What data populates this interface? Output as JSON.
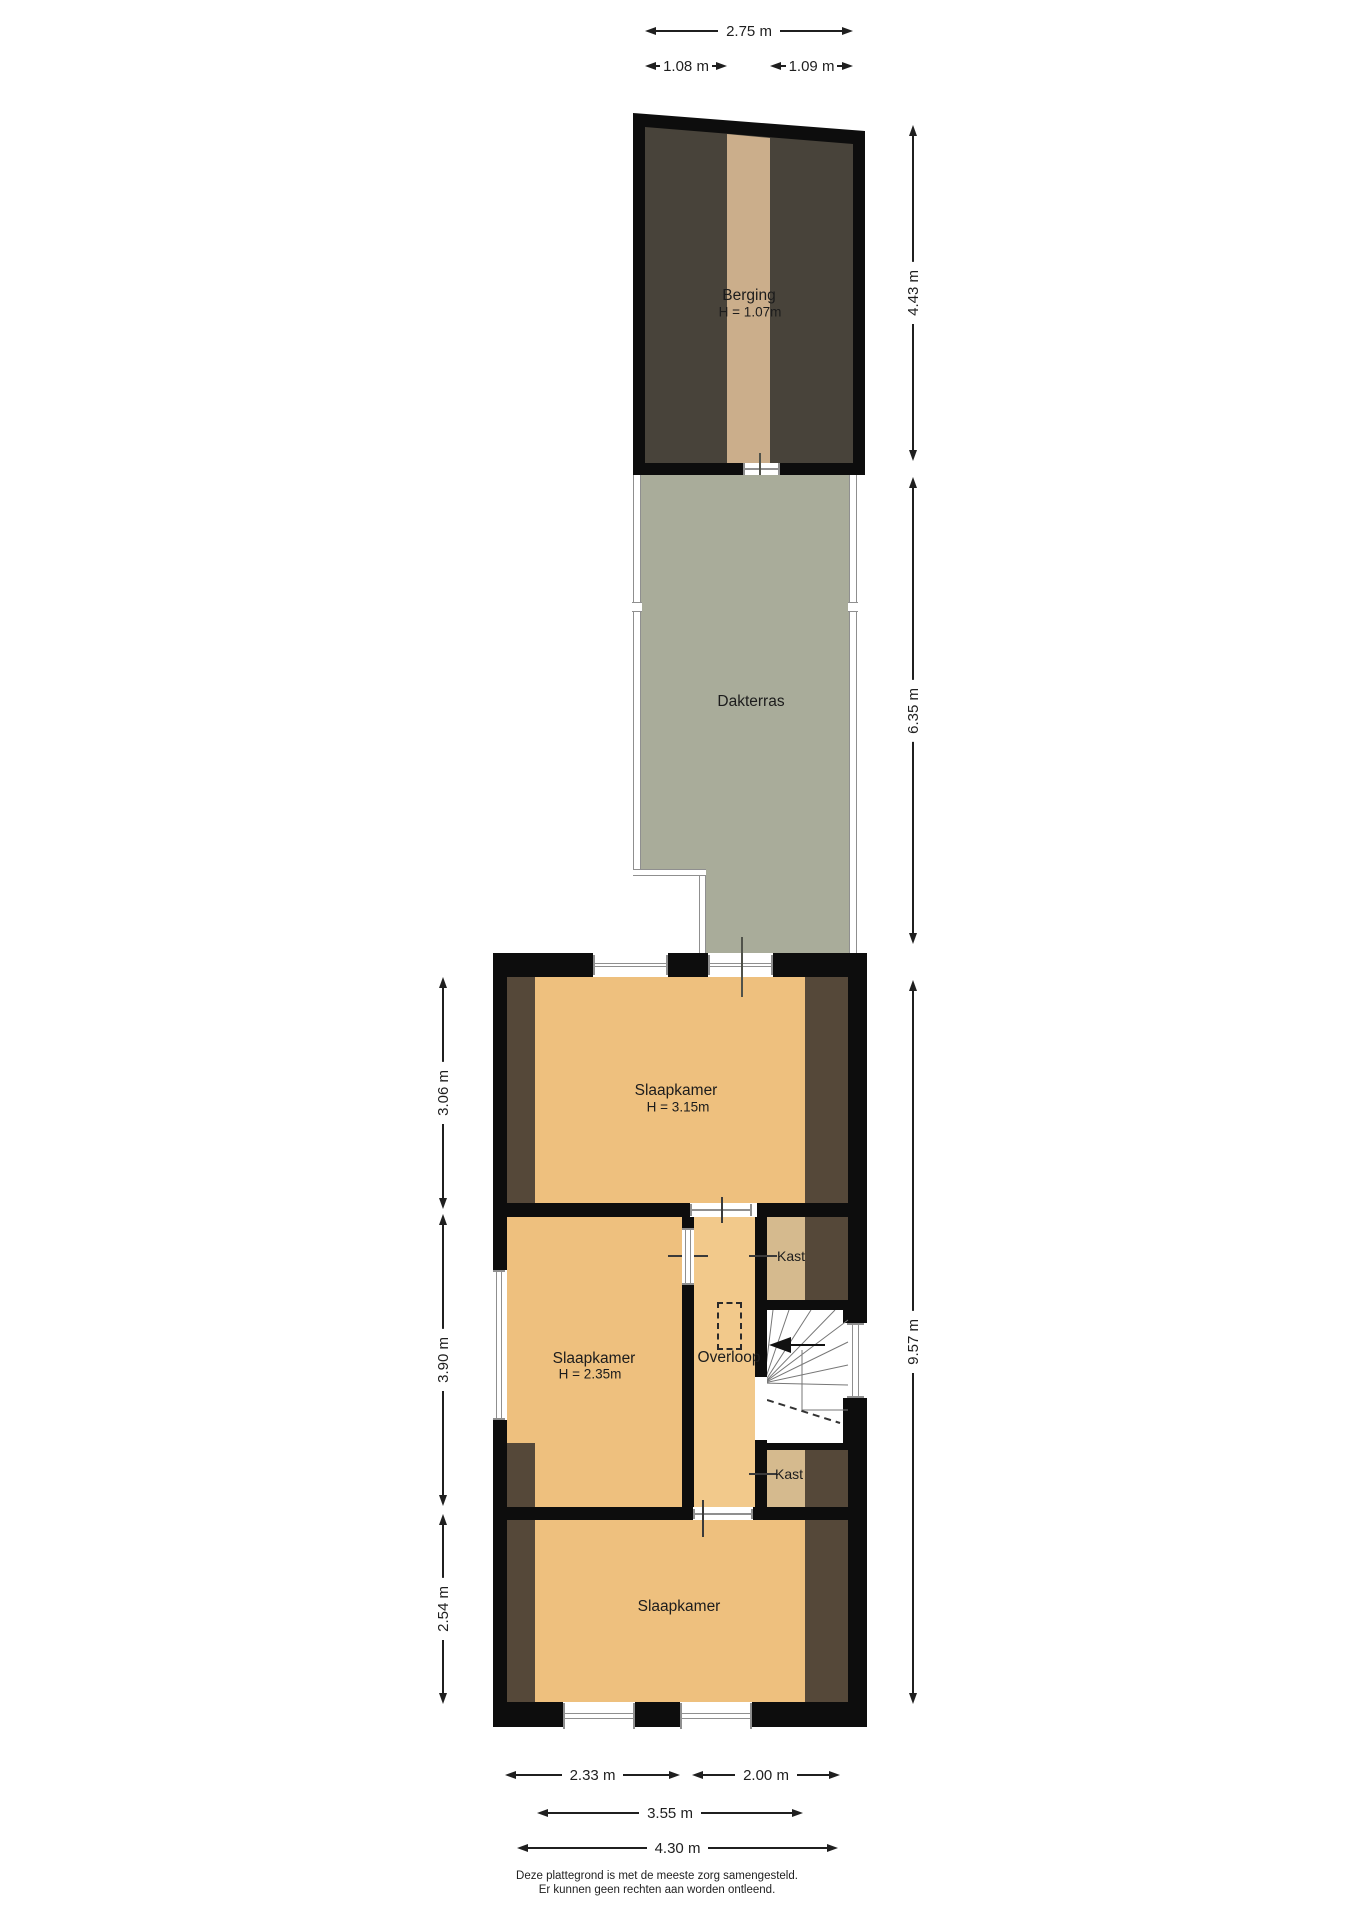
{
  "rooms": {
    "berging": {
      "label": "Berging",
      "height": "H = 1.07m"
    },
    "dakterras": {
      "label": "Dakterras"
    },
    "slaapkamer_boven": {
      "label": "Slaapkamer",
      "height": "H = 3.15m"
    },
    "slaapkamer_midden": {
      "label": "Slaapkamer",
      "height": "H = 2.35m"
    },
    "slaapkamer_onder": {
      "label": "Slaapkamer"
    },
    "overloop": {
      "label": "Overloop"
    },
    "kast_boven": {
      "label": "Kast"
    },
    "kast_onder": {
      "label": "Kast"
    }
  },
  "dimensions": {
    "top": {
      "total": "2.75 m",
      "left": "1.08 m",
      "right": "1.09 m"
    },
    "right": {
      "berging": "4.43 m",
      "dakterras": "6.35 m",
      "verdieping": "9.57 m"
    },
    "left": {
      "boven": "3.06 m",
      "midden": "3.90 m",
      "onder": "2.54 m"
    },
    "bottom": {
      "kamer_links": "2.33 m",
      "kamer_rechts": "2.00 m",
      "binnen": "3.55 m",
      "totaal": "4.30 m"
    }
  },
  "footer": {
    "line1": "Deze plattegrond is met de meeste zorg samengesteld.",
    "line2": "Er kunnen geen rechten aan worden ontleend."
  },
  "colors": {
    "wall": "#0d0d0d",
    "room": "#eec07e",
    "hal": "#f2c98b",
    "kast": "#d5ba8e",
    "beam": "#554839",
    "bergdark": "#48433a",
    "bergfloor": "#cbae8b",
    "terras": "#a9ac9a",
    "dim": "#1f1f1f",
    "gline": "#8f8f8f",
    "door": "#50524a",
    "stair": "#777777"
  }
}
